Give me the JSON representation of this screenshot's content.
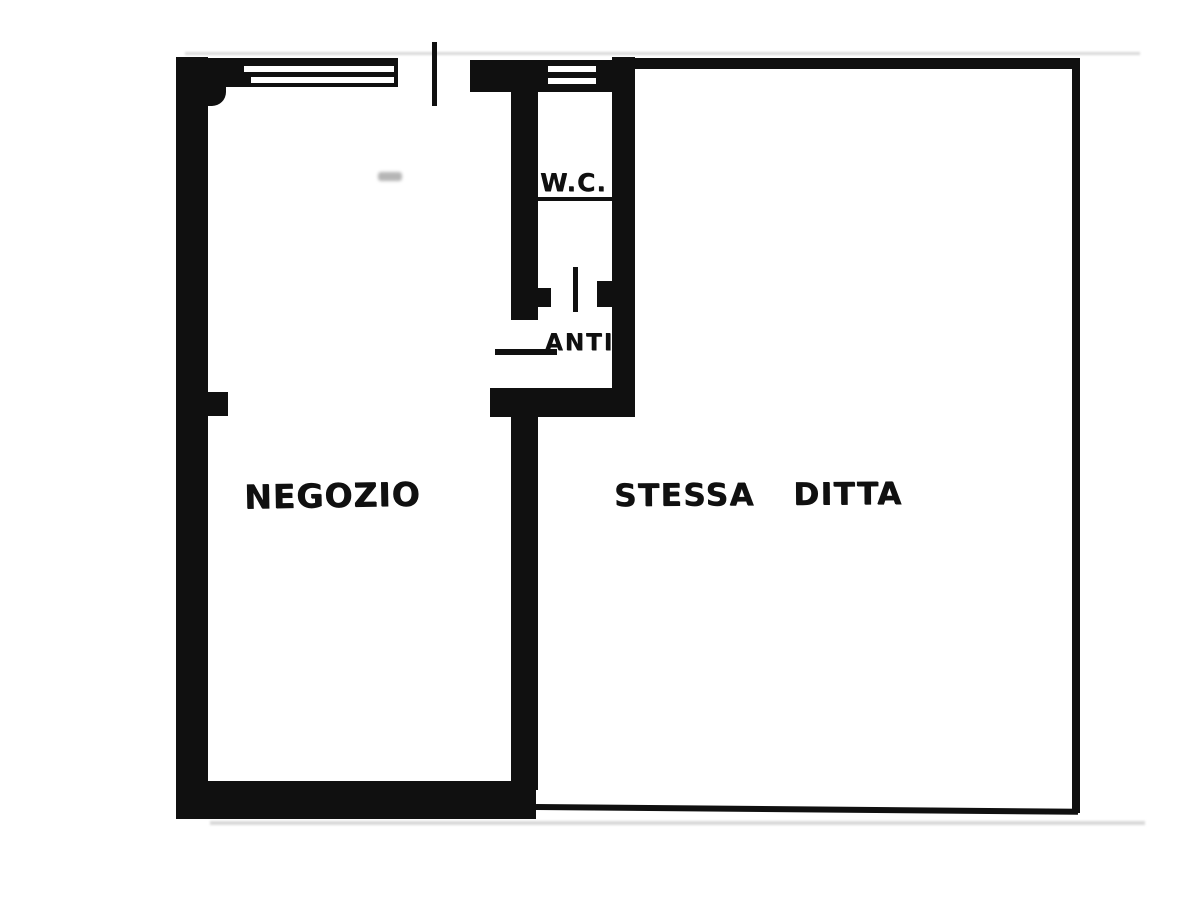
{
  "plan": {
    "type": "floor-plan",
    "rooms": {
      "negozio": {
        "label": "NEGOZIO"
      },
      "stessa_ditta": {
        "label": "STESSA DITTA"
      },
      "wc": {
        "label": "W.C."
      },
      "anti": {
        "label": "ANTI"
      }
    },
    "colors": {
      "ink": "#101010",
      "background": "#ffffff",
      "smudge": "#b5b5b5",
      "shadow": "#d9d9d9"
    }
  }
}
